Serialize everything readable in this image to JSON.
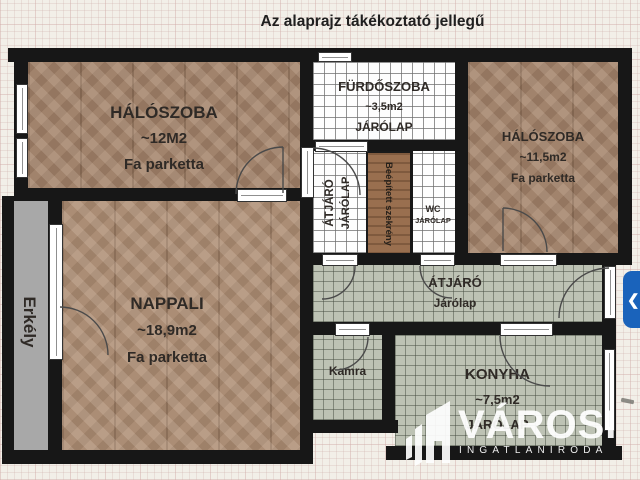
{
  "title": "Az alaprajz tákékoztató jellegű",
  "rooms": {
    "bedroom_left": {
      "name": "HÁLÓSZOBA",
      "area": "~12M2",
      "floor": "Fa parketta"
    },
    "bathroom": {
      "name": "FÜRDŐSZOBA",
      "area": "~3,5m2",
      "floor": "JÁRÓLAP"
    },
    "bedroom_right": {
      "name": "HÁLÓSZOBA",
      "area": "~11,5m2",
      "floor": "Fa parketta"
    },
    "passage": {
      "name": "ÁTJÁRÓ",
      "floor": "JÁRÓLAP"
    },
    "closet": {
      "name": "Beépített szekrény"
    },
    "wc": {
      "name": "WC",
      "floor": "JÁRÓLAP"
    },
    "living_room": {
      "name": "NAPPALI",
      "area": "~18,9m2",
      "floor": "Fa parketta"
    },
    "hallway": {
      "name": "ÁTJÁRÓ",
      "floor": "Járólap"
    },
    "pantry": {
      "name": "Kamra"
    },
    "kitchen": {
      "name": "KONYHA",
      "area": "~7,5m2",
      "floor": "JÁRÓLAP"
    },
    "balcony": {
      "name": "Erkély"
    }
  },
  "watermark": {
    "brand": "VÁROSI",
    "subtitle": "INGATLANIRODA",
    "logo_icon": "building-icon"
  },
  "nav": {
    "prev_icon": "❮"
  },
  "colors": {
    "wall": "#171717",
    "parquet": "#a1836c",
    "parquet_light": "#ab8d75",
    "tile_white": "#fdfdfd",
    "tile_green": "#bdc2b4",
    "balcony_gray": "#a8a8a8",
    "closet_wood": "#996f4f",
    "button_blue": "#1a63bb",
    "background": "#f2efe8"
  }
}
